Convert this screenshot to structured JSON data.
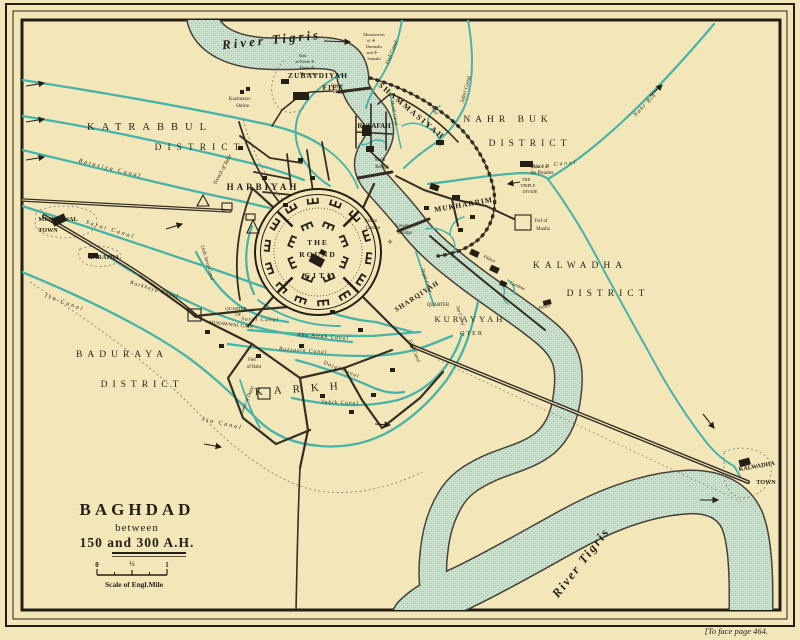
{
  "title_block": {
    "title": "BAGHDAD",
    "line2": "between",
    "line3": "150 and 300 A.H.",
    "scale_label": "Scale of Engl.Mile",
    "scale_ticks": [
      "0",
      "½",
      "1"
    ]
  },
  "caption": "[To face page 464.",
  "palette": {
    "paper": "#f3e7ba",
    "river_fill": "#cadfcc",
    "river_stipple": "#9fc2ab",
    "canal_teal": "#47b3a7",
    "ink": "#241f15"
  },
  "map": {
    "labels": [
      {
        "t": "River Tigris",
        "x": 272,
        "y": 44,
        "s": 13,
        "c": "script",
        "r": -6,
        "ls": 3
      },
      {
        "t": "River Tigris",
        "x": 584,
        "y": 565,
        "s": 12.5,
        "c": "script",
        "r": -52,
        "ls": 2
      },
      {
        "t": "KATRABBUL",
        "x": 150,
        "y": 130,
        "s": 10.5,
        "c": "district",
        "ls": 7
      },
      {
        "t": "DISTRICT",
        "x": 200,
        "y": 150,
        "s": 9.5,
        "c": "district",
        "ls": 6
      },
      {
        "t": "NAHR BUK",
        "x": 508,
        "y": 122,
        "s": 9.5,
        "c": "district",
        "ls": 5
      },
      {
        "t": "DISTRICT",
        "x": 530,
        "y": 146,
        "s": 9.5,
        "c": "district",
        "ls": 5
      },
      {
        "t": "KALWADHA",
        "x": 580,
        "y": 268,
        "s": 9.5,
        "c": "district",
        "ls": 5
      },
      {
        "t": "DISTRICT",
        "x": 608,
        "y": 296,
        "s": 9.5,
        "c": "district",
        "ls": 5
      },
      {
        "t": "BADURAYA",
        "x": 122,
        "y": 357,
        "s": 9.5,
        "c": "district",
        "ls": 5
      },
      {
        "t": "DISTRICT",
        "x": 142,
        "y": 387,
        "s": 9.5,
        "c": "district",
        "ls": 5
      },
      {
        "t": "KARKH",
        "x": 302,
        "y": 392,
        "s": 11,
        "c": "district",
        "ls": 11,
        "r": -4
      },
      {
        "t": "KURAYYAH",
        "x": 470,
        "y": 322,
        "s": 8.5,
        "c": "district",
        "ls": 3
      },
      {
        "t": "QTER",
        "x": 472,
        "y": 335,
        "s": 6,
        "c": "district",
        "ls": 2
      },
      {
        "t": "HARBIYAH",
        "x": 263,
        "y": 190,
        "s": 9,
        "c": "quarter",
        "ls": 3
      },
      {
        "t": "ZUBAYDIYAH",
        "x": 318,
        "y": 78,
        "s": 7.5,
        "c": "quarter",
        "ls": 1
      },
      {
        "t": "FIEF",
        "x": 333,
        "y": 90,
        "s": 7.5,
        "c": "quarter",
        "ls": 1
      },
      {
        "t": "SHAMMASIYAH",
        "x": 410,
        "y": 113,
        "s": 8,
        "c": "quarter",
        "ls": 2,
        "r": 40
      },
      {
        "t": "RUSAFAH",
        "x": 374,
        "y": 128,
        "s": 7,
        "c": "quarter"
      },
      {
        "t": "MUKHARRIM",
        "x": 464,
        "y": 207,
        "s": 7.5,
        "c": "quarter",
        "ls": 1,
        "r": -10
      },
      {
        "t": "SHARQIYAH",
        "x": 418,
        "y": 298,
        "s": 7,
        "c": "quarter",
        "ls": 1,
        "r": -33
      },
      {
        "t": "QUARTER",
        "x": 438,
        "y": 306,
        "s": 4.8,
        "c": "feature"
      },
      {
        "t": "THE",
        "x": 318,
        "y": 245,
        "s": 7.5,
        "c": "quarter",
        "ls": 2
      },
      {
        "t": "ROUND",
        "x": 318,
        "y": 257,
        "s": 7.5,
        "c": "quarter",
        "ls": 2
      },
      {
        "t": "CITY",
        "x": 320,
        "y": 278,
        "s": 7.5,
        "c": "quarter",
        "ls": 3
      },
      {
        "t": "MUHAWWAL",
        "x": 58,
        "y": 221,
        "s": 6.2,
        "c": "town"
      },
      {
        "t": "TOWN",
        "x": 48,
        "y": 232,
        "s": 6.2,
        "c": "town"
      },
      {
        "t": "BARATHA",
        "x": 104,
        "y": 259,
        "s": 6.2,
        "c": "town"
      },
      {
        "t": "KALWADHA",
        "x": 757,
        "y": 468,
        "s": 6.2,
        "c": "town",
        "r": -10
      },
      {
        "t": "TOWN",
        "x": 766,
        "y": 484,
        "s": 6.2,
        "c": "town"
      },
      {
        "t": "QUARTER",
        "x": 236,
        "y": 310,
        "s": 4.6,
        "c": "feature"
      },
      {
        "t": "OF",
        "x": 238,
        "y": 316,
        "s": 4.6,
        "c": "feature"
      },
      {
        "t": "MUHAWWAL GATE",
        "x": 231,
        "y": 326,
        "s": 5,
        "c": "feature",
        "r": 6
      },
      {
        "t": "Fief",
        "x": 252,
        "y": 361,
        "s": 4.8,
        "c": "feature"
      },
      {
        "t": "of Rabi",
        "x": 254,
        "y": 368,
        "s": 4.8,
        "c": "feature"
      },
      {
        "t": "Fief of",
        "x": 541,
        "y": 222,
        "s": 4.8,
        "c": "feature"
      },
      {
        "t": "Mualla",
        "x": 543,
        "y": 230,
        "s": 4.8,
        "c": "feature"
      },
      {
        "t": "Batasiya Canal",
        "x": 110,
        "y": 170,
        "s": 6,
        "c": "canal",
        "r": 14,
        "ls": 2
      },
      {
        "t": "Sarat Canal",
        "x": 110,
        "y": 231,
        "s": 6,
        "c": "canal",
        "r": 17,
        "ls": 2
      },
      {
        "t": "Little Sarat Canal",
        "x": 206,
        "y": 263,
        "s": 5,
        "c": "canal",
        "r": 74
      },
      {
        "t": "Sarat Canal",
        "x": 260,
        "y": 321,
        "s": 5.5,
        "c": "canal",
        "r": 2,
        "ls": 1
      },
      {
        "t": "Karkhaya Canal",
        "x": 154,
        "y": 291,
        "s": 5.5,
        "c": "canal",
        "r": 17,
        "ls": 1
      },
      {
        "t": "Isa Canal",
        "x": 64,
        "y": 304,
        "s": 6,
        "c": "canal",
        "r": 20,
        "ls": 2
      },
      {
        "t": "Isa Canal",
        "x": 222,
        "y": 425,
        "s": 6,
        "c": "canal",
        "r": 13,
        "ls": 2
      },
      {
        "t": "Isa Canal",
        "x": 459,
        "y": 316,
        "s": 5,
        "c": "canal",
        "r": 74
      },
      {
        "t": "Bazzazin Canal",
        "x": 303,
        "y": 352,
        "s": 5.5,
        "c": "canal",
        "r": 4,
        "ls": 1
      },
      {
        "t": "Abu Attab Canal",
        "x": 323,
        "y": 338,
        "s": 5.5,
        "c": "canal",
        "r": 4,
        "ls": 1
      },
      {
        "t": "Dajal Canal",
        "x": 341,
        "y": 371,
        "s": 5.5,
        "c": "canal",
        "r": 22,
        "ls": 1
      },
      {
        "t": "Dajal Canal",
        "x": 425,
        "y": 281,
        "s": 5,
        "c": "canal",
        "r": 72
      },
      {
        "t": "Tabik Canal",
        "x": 340,
        "y": 404,
        "s": 5.5,
        "c": "canal",
        "r": 2,
        "ls": 1
      },
      {
        "t": "Tabik Canal",
        "x": 413,
        "y": 351,
        "s": 5,
        "c": "canal",
        "r": 68
      },
      {
        "t": "Canal of Dajaj",
        "x": 248,
        "y": 401,
        "s": 5,
        "c": "canal",
        "r": -68
      },
      {
        "t": "Fadl Canal",
        "x": 393,
        "y": 53,
        "s": 5.5,
        "c": "canal",
        "r": -68
      },
      {
        "t": "Jafari Canal",
        "x": 467,
        "y": 90,
        "s": 5.5,
        "c": "canal",
        "r": -75
      },
      {
        "t": "Mahdi Canal",
        "x": 393,
        "y": 113,
        "s": 4.8,
        "c": "canal",
        "r": 80
      },
      {
        "t": "Musa Canal",
        "x": 554,
        "y": 166,
        "s": 5.5,
        "c": "canal",
        "r": -6,
        "ls": 2
      },
      {
        "t": "Nahr Bin",
        "x": 646,
        "y": 106,
        "s": 6,
        "c": "canal",
        "r": -46,
        "ls": 1
      },
      {
        "t": "Trench of Tahir",
        "x": 224,
        "y": 170,
        "s": 5.5,
        "c": "canal",
        "r": -62
      },
      {
        "t": "Wall",
        "x": 433,
        "y": 111,
        "s": 5,
        "c": "canal",
        "r": 62
      },
      {
        "t": "Kazimayn-",
        "x": 240,
        "y": 100,
        "s": 5,
        "c": "feature"
      },
      {
        "t": "Shrine.",
        "x": 243,
        "y": 107,
        "s": 5,
        "c": "feature"
      },
      {
        "t": "Dair",
        "x": 303,
        "y": 57,
        "s": 4.4,
        "c": "feature"
      },
      {
        "t": "al-Kilab ✛",
        "x": 305,
        "y": 63,
        "s": 4.4,
        "c": "feature"
      },
      {
        "t": "Durta ✛",
        "x": 307,
        "y": 69,
        "s": 4.4,
        "c": "feature"
      },
      {
        "t": "Monastery",
        "x": 309,
        "y": 75,
        "s": 4.4,
        "c": "feature"
      },
      {
        "t": "Monasteries",
        "x": 374,
        "y": 36,
        "s": 4.4,
        "c": "feature"
      },
      {
        "t": "of ✛",
        "x": 371,
        "y": 42,
        "s": 4.4,
        "c": "feature"
      },
      {
        "t": "Durmalis",
        "x": 374,
        "y": 48,
        "s": 4.4,
        "c": "feature"
      },
      {
        "t": "and ✛",
        "x": 372,
        "y": 54,
        "s": 4.4,
        "c": "feature"
      },
      {
        "t": "Samalu",
        "x": 374,
        "y": 60,
        "s": 4.4,
        "c": "feature"
      },
      {
        "t": "Upper",
        "x": 337,
        "y": 87,
        "s": 4.8,
        "c": "feature"
      },
      {
        "t": "Bridge",
        "x": 339,
        "y": 93,
        "s": 4.8,
        "c": "feature"
      },
      {
        "t": "Main",
        "x": 380,
        "y": 161,
        "s": 5,
        "c": "feature"
      },
      {
        "t": "Bridge",
        "x": 382,
        "y": 168,
        "s": 5,
        "c": "feature"
      },
      {
        "t": "Lower",
        "x": 402,
        "y": 227,
        "s": 5,
        "c": "feature"
      },
      {
        "t": "Bridge",
        "x": 405,
        "y": 234,
        "s": 5,
        "c": "feature"
      },
      {
        "t": "Palace",
        "x": 371,
        "y": 222,
        "s": 4.8,
        "c": "feature"
      },
      {
        "t": "Garden",
        "x": 373,
        "y": 229,
        "s": 4.8,
        "c": "feature"
      },
      {
        "t": "✛",
        "x": 390,
        "y": 244,
        "s": 6,
        "c": "feature"
      },
      {
        "t": "Palace of",
        "x": 540,
        "y": 168,
        "s": 4.8,
        "c": "feature"
      },
      {
        "t": "the Pleiades",
        "x": 542,
        "y": 174,
        "s": 4.8,
        "c": "feature"
      },
      {
        "t": "THE",
        "x": 526,
        "y": 181,
        "s": 4.4,
        "c": "feature"
      },
      {
        "t": "TRIPLE",
        "x": 528,
        "y": 187,
        "s": 4.4,
        "c": "feature"
      },
      {
        "t": "DIVIDE",
        "x": 530,
        "y": 193,
        "s": 4.4,
        "c": "feature"
      },
      {
        "t": "Palace",
        "x": 489,
        "y": 260,
        "s": 4.8,
        "c": "feature",
        "r": 25
      },
      {
        "t": "Gardens",
        "x": 517,
        "y": 287,
        "s": 4.8,
        "c": "feature",
        "r": 25
      },
      {
        "t": "Palace",
        "x": 545,
        "y": 308,
        "s": 4.8,
        "c": "feature",
        "r": -15
      }
    ]
  }
}
